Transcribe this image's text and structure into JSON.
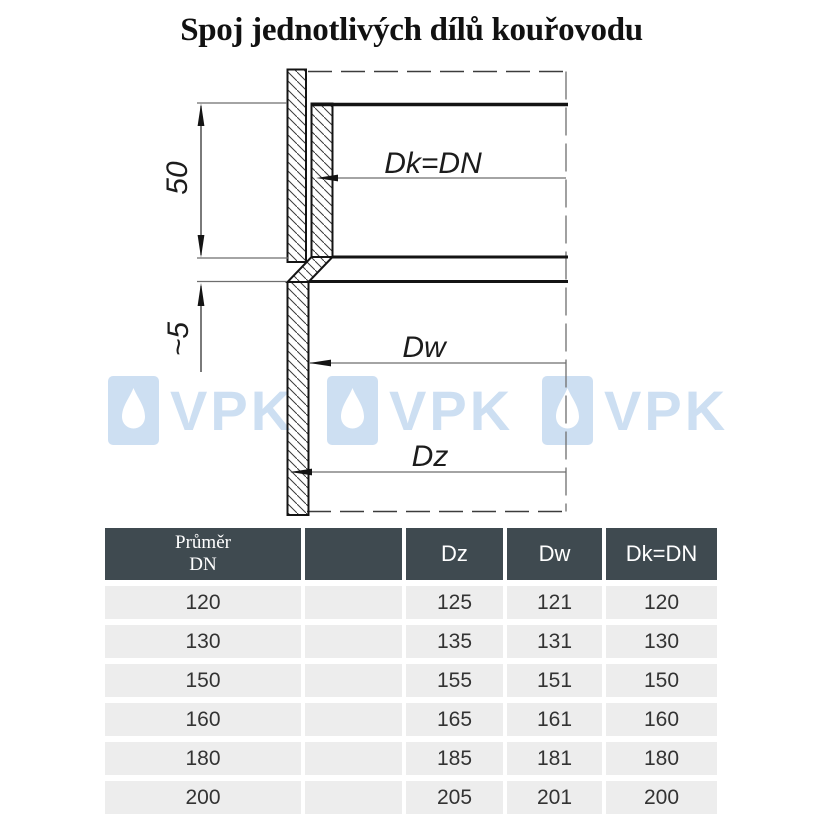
{
  "title": "Spoj jednotlivých dílů kouřovodu",
  "diagram": {
    "dim_insertion_depth": "50",
    "dim_gap": "~5",
    "label_dk": "Dk=DN",
    "label_dw": "Dw",
    "label_dz": "Dz"
  },
  "watermark": {
    "text": "VPK",
    "count": 3
  },
  "table": {
    "header": {
      "diameter_line1": "Průměr",
      "diameter_line2": "DN",
      "spacer": "",
      "dz": "Dz",
      "dw": "Dw",
      "dk": "Dk=DN"
    },
    "rows": [
      {
        "dn": "120",
        "spacer": "",
        "dz": "125",
        "dw": "121",
        "dk": "120"
      },
      {
        "dn": "130",
        "spacer": "",
        "dz": "135",
        "dw": "131",
        "dk": "130"
      },
      {
        "dn": "150",
        "spacer": "",
        "dz": "155",
        "dw": "151",
        "dk": "150"
      },
      {
        "dn": "160",
        "spacer": "",
        "dz": "165",
        "dw": "161",
        "dk": "160"
      },
      {
        "dn": "180",
        "spacer": "",
        "dz": "185",
        "dw": "181",
        "dk": "180"
      },
      {
        "dn": "200",
        "spacer": "",
        "dz": "205",
        "dw": "201",
        "dk": "200"
      }
    ]
  },
  "colors": {
    "header_bg": "#3F4A50",
    "header_text": "#FFFFFF",
    "row_bg": "#EDEDED",
    "watermark": "#CDDFF2",
    "line": "#141414"
  }
}
